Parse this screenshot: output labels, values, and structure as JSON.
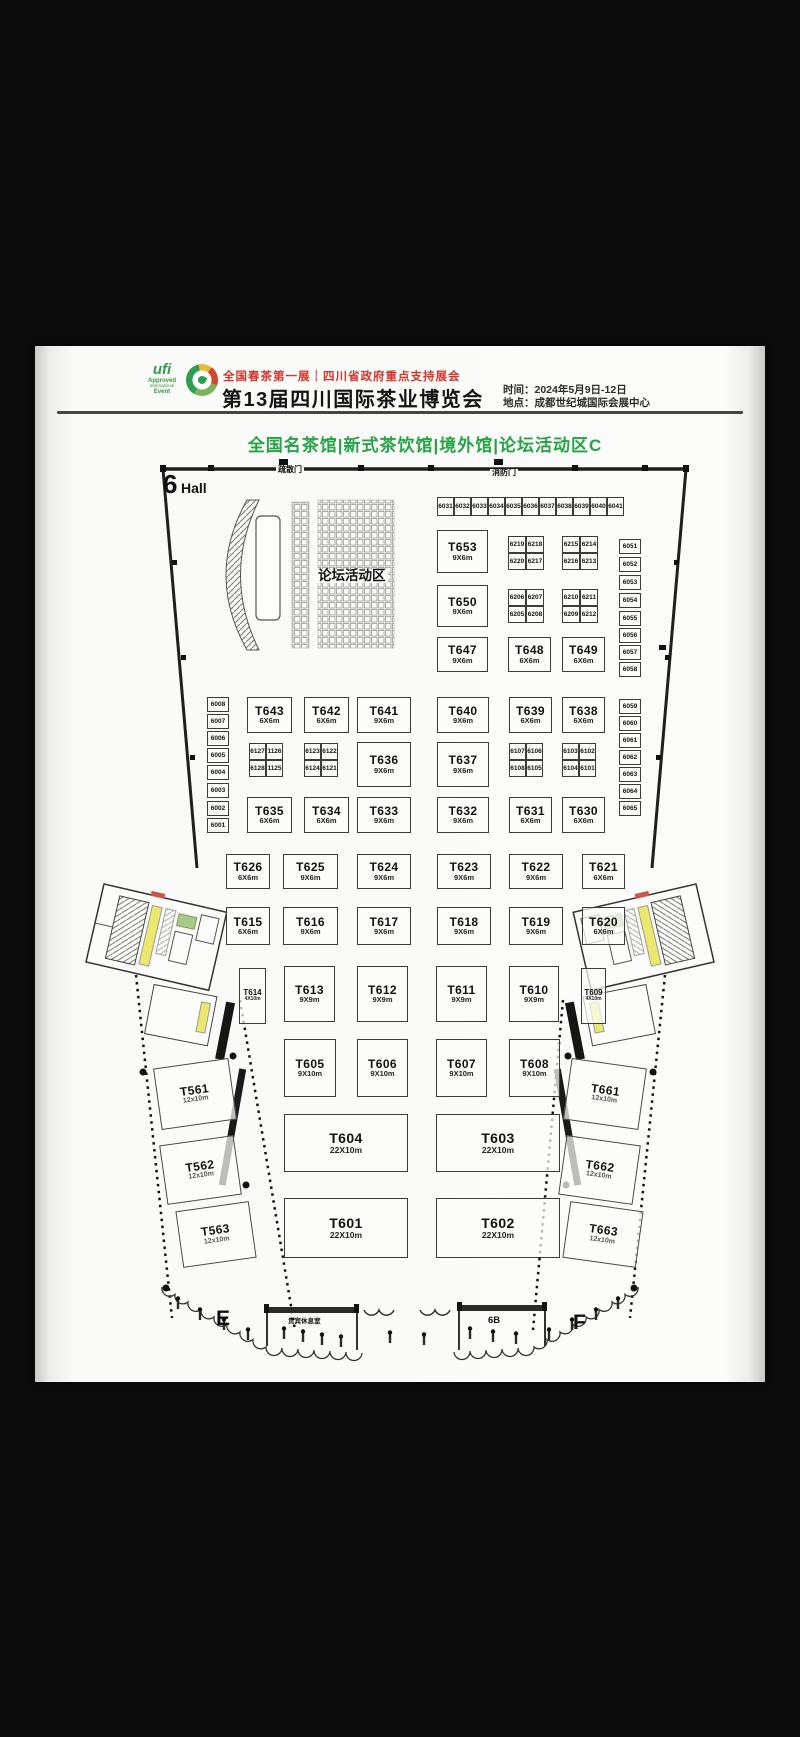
{
  "header": {
    "ufi_logo_lines": [
      "ufi",
      "Approved",
      "International",
      "Event"
    ],
    "expo_logo": "tea-expo-circle-logo",
    "tagline": "全国春茶第一展｜四川省政府重点支持展会",
    "title": "第13届四川国际茶业博览会",
    "time": "时间：2024年5月9日-12日",
    "venue": "地点：成都世纪城国际会展中心"
  },
  "subtitle": "全国名茶馆|新式茶饮馆|境外馆|论坛活动区C",
  "colors": {
    "accent_green": "#27a347",
    "accent_red": "#d6342b",
    "line": "#3b3b3b"
  },
  "floorplan": {
    "labels": [
      {
        "name": "hall-number",
        "text": "6",
        "x": 163,
        "y": 471,
        "fs": 26,
        "fw": 800
      },
      {
        "name": "hall-word",
        "text": "Hall",
        "x": 181,
        "y": 481,
        "fs": 14,
        "fw": 800
      },
      {
        "name": "door-evac-label",
        "text": "疏散门",
        "x": 276,
        "y": 466,
        "fs": 8,
        "fw": 700,
        "bg": 1
      },
      {
        "name": "door-fire-label",
        "text": "消防门",
        "x": 490,
        "y": 469,
        "fs": 8,
        "fw": 700,
        "bg": 1
      },
      {
        "name": "forum-area-label",
        "text": "论坛活动区",
        "x": 316,
        "y": 569,
        "fs": 13.5,
        "fw": 800,
        "bg": 1
      },
      {
        "name": "zone-e-label",
        "text": "E",
        "x": 216,
        "y": 1308,
        "fs": 21,
        "fw": 800
      },
      {
        "name": "zone-6b-label",
        "text": "6B",
        "x": 488,
        "y": 1316,
        "fs": 9.5,
        "fw": 800
      },
      {
        "name": "zone-f-label",
        "text": "F",
        "x": 573,
        "y": 1312,
        "fs": 21,
        "fw": 800
      },
      {
        "name": "vip-room-label",
        "text": "贵宾休息室",
        "x": 288,
        "y": 1319,
        "fs": 6.5,
        "fw": 600
      }
    ],
    "booths": [
      {
        "id": "T653",
        "size": "9X6m",
        "x": 437,
        "y": 530,
        "w": 51,
        "h": 43
      },
      {
        "id": "T650",
        "size": "9X6m",
        "x": 437,
        "y": 585,
        "w": 51,
        "h": 42
      },
      {
        "id": "T647",
        "size": "9X6m",
        "x": 437,
        "y": 637,
        "w": 51,
        "h": 35
      },
      {
        "id": "T648",
        "size": "6X6m",
        "x": 508,
        "y": 637,
        "w": 43,
        "h": 35
      },
      {
        "id": "T649",
        "size": "6X6m",
        "x": 562,
        "y": 637,
        "w": 43,
        "h": 35
      },
      {
        "id": "T643",
        "size": "6X6m",
        "x": 247,
        "y": 697,
        "w": 45,
        "h": 36
      },
      {
        "id": "T642",
        "size": "6X6m",
        "x": 304,
        "y": 697,
        "w": 45,
        "h": 36
      },
      {
        "id": "T641",
        "size": "9X6m",
        "x": 357,
        "y": 697,
        "w": 54,
        "h": 36
      },
      {
        "id": "T640",
        "size": "9X6m",
        "x": 437,
        "y": 697,
        "w": 52,
        "h": 36
      },
      {
        "id": "T639",
        "size": "6X6m",
        "x": 509,
        "y": 697,
        "w": 43,
        "h": 36
      },
      {
        "id": "T638",
        "size": "6X6m",
        "x": 562,
        "y": 697,
        "w": 43,
        "h": 36
      },
      {
        "id": "T636",
        "size": "9X6m",
        "x": 357,
        "y": 742,
        "w": 54,
        "h": 45
      },
      {
        "id": "T637",
        "size": "9X6m",
        "x": 437,
        "y": 742,
        "w": 52,
        "h": 45
      },
      {
        "id": "T635",
        "size": "6X6m",
        "x": 247,
        "y": 797,
        "w": 45,
        "h": 36
      },
      {
        "id": "T634",
        "size": "6X6m",
        "x": 304,
        "y": 797,
        "w": 45,
        "h": 36
      },
      {
        "id": "T633",
        "size": "9X6m",
        "x": 357,
        "y": 797,
        "w": 54,
        "h": 36
      },
      {
        "id": "T632",
        "size": "9X6m",
        "x": 437,
        "y": 797,
        "w": 52,
        "h": 36
      },
      {
        "id": "T631",
        "size": "6X6m",
        "x": 509,
        "y": 797,
        "w": 43,
        "h": 36
      },
      {
        "id": "T630",
        "size": "6X6m",
        "x": 562,
        "y": 797,
        "w": 43,
        "h": 36
      },
      {
        "id": "T626",
        "size": "6X6m",
        "x": 226,
        "y": 854,
        "w": 44,
        "h": 35
      },
      {
        "id": "T625",
        "size": "9X6m",
        "x": 283,
        "y": 854,
        "w": 55,
        "h": 35
      },
      {
        "id": "T624",
        "size": "9X6m",
        "x": 357,
        "y": 854,
        "w": 54,
        "h": 35
      },
      {
        "id": "T623",
        "size": "9X6m",
        "x": 437,
        "y": 854,
        "w": 54,
        "h": 35
      },
      {
        "id": "T622",
        "size": "9X6m",
        "x": 509,
        "y": 854,
        "w": 54,
        "h": 35
      },
      {
        "id": "T621",
        "size": "6X6m",
        "x": 582,
        "y": 854,
        "w": 43,
        "h": 35
      },
      {
        "id": "T615",
        "size": "6X6m",
        "x": 226,
        "y": 907,
        "w": 44,
        "h": 38
      },
      {
        "id": "T616",
        "size": "9X6m",
        "x": 283,
        "y": 907,
        "w": 55,
        "h": 38
      },
      {
        "id": "T617",
        "size": "9X6m",
        "x": 357,
        "y": 907,
        "w": 54,
        "h": 38
      },
      {
        "id": "T618",
        "size": "9X6m",
        "x": 437,
        "y": 907,
        "w": 54,
        "h": 38
      },
      {
        "id": "T619",
        "size": "9X6m",
        "x": 509,
        "y": 907,
        "w": 54,
        "h": 38
      },
      {
        "id": "T620",
        "size": "6X6m",
        "x": 582,
        "y": 907,
        "w": 43,
        "h": 38
      },
      {
        "id": "T614",
        "size": "4X10m",
        "x": 239,
        "y": 968,
        "w": 27,
        "h": 56,
        "kind": "narrow"
      },
      {
        "id": "T613",
        "size": "9X9m",
        "x": 284,
        "y": 966,
        "w": 51,
        "h": 56
      },
      {
        "id": "T612",
        "size": "9X9m",
        "x": 357,
        "y": 966,
        "w": 51,
        "h": 56
      },
      {
        "id": "T611",
        "size": "9X9m",
        "x": 436,
        "y": 966,
        "w": 51,
        "h": 56
      },
      {
        "id": "T610",
        "size": "9X9m",
        "x": 509,
        "y": 966,
        "w": 50,
        "h": 56
      },
      {
        "id": "T609",
        "size": "4X10m",
        "x": 581,
        "y": 968,
        "w": 25,
        "h": 56,
        "kind": "narrow"
      },
      {
        "id": "T605",
        "size": "9X10m",
        "x": 284,
        "y": 1039,
        "w": 52,
        "h": 58
      },
      {
        "id": "T606",
        "size": "9X10m",
        "x": 357,
        "y": 1039,
        "w": 51,
        "h": 58
      },
      {
        "id": "T607",
        "size": "9X10m",
        "x": 436,
        "y": 1039,
        "w": 51,
        "h": 58
      },
      {
        "id": "T608",
        "size": "9X10m",
        "x": 509,
        "y": 1039,
        "w": 51,
        "h": 58
      },
      {
        "id": "T604",
        "size": "22X10m",
        "x": 284,
        "y": 1114,
        "w": 124,
        "h": 58,
        "kind": "wide"
      },
      {
        "id": "T603",
        "size": "22X10m",
        "x": 436,
        "y": 1114,
        "w": 124,
        "h": 58,
        "kind": "wide"
      },
      {
        "id": "T601",
        "size": "22X10m",
        "x": 284,
        "y": 1198,
        "w": 124,
        "h": 60,
        "kind": "wide"
      },
      {
        "id": "T602",
        "size": "22X10m",
        "x": 436,
        "y": 1198,
        "w": 124,
        "h": 60,
        "kind": "wide"
      },
      {
        "id": "T561",
        "size": "12x10m",
        "x": 157,
        "y": 1063,
        "w": 76,
        "h": 62,
        "kind": "wing",
        "rot": -8
      },
      {
        "id": "T562",
        "size": "12x10m",
        "x": 163,
        "y": 1140,
        "w": 75,
        "h": 60,
        "kind": "wing",
        "rot": -8
      },
      {
        "id": "T563",
        "size": "12x10m",
        "x": 179,
        "y": 1206,
        "w": 74,
        "h": 57,
        "kind": "wing",
        "rot": -8
      },
      {
        "id": "T661",
        "size": "12x10m",
        "x": 567,
        "y": 1063,
        "w": 76,
        "h": 62,
        "kind": "wing",
        "rot": 8
      },
      {
        "id": "T662",
        "size": "12x10m",
        "x": 562,
        "y": 1140,
        "w": 75,
        "h": 60,
        "kind": "wing",
        "rot": 8
      },
      {
        "id": "T663",
        "size": "12x10m",
        "x": 566,
        "y": 1206,
        "w": 74,
        "h": 57,
        "kind": "wing",
        "rot": 8
      }
    ],
    "small_booths": [
      {
        "id": "6031",
        "x": 437,
        "y": 497,
        "w": 17,
        "h": 19
      },
      {
        "id": "6032",
        "x": 454,
        "y": 497,
        "w": 17,
        "h": 19
      },
      {
        "id": "6033",
        "x": 471,
        "y": 497,
        "w": 17,
        "h": 19
      },
      {
        "id": "6034",
        "x": 488,
        "y": 497,
        "w": 17,
        "h": 19
      },
      {
        "id": "6035",
        "x": 505,
        "y": 497,
        "w": 17,
        "h": 19
      },
      {
        "id": "6036",
        "x": 522,
        "y": 497,
        "w": 17,
        "h": 19
      },
      {
        "id": "6037",
        "x": 539,
        "y": 497,
        "w": 17,
        "h": 19
      },
      {
        "id": "6038",
        "x": 556,
        "y": 497,
        "w": 17,
        "h": 19
      },
      {
        "id": "6039",
        "x": 573,
        "y": 497,
        "w": 17,
        "h": 19
      },
      {
        "id": "6040",
        "x": 590,
        "y": 497,
        "w": 17,
        "h": 19
      },
      {
        "id": "6041",
        "x": 607,
        "y": 497,
        "w": 17,
        "h": 19
      },
      {
        "id": "6219",
        "x": 508,
        "y": 536,
        "w": 18,
        "h": 17
      },
      {
        "id": "6218",
        "x": 526,
        "y": 536,
        "w": 18,
        "h": 17
      },
      {
        "id": "6220",
        "x": 508,
        "y": 553,
        "w": 18,
        "h": 17
      },
      {
        "id": "6217",
        "x": 526,
        "y": 553,
        "w": 18,
        "h": 17
      },
      {
        "id": "6215",
        "x": 562,
        "y": 536,
        "w": 18,
        "h": 17
      },
      {
        "id": "6214",
        "x": 580,
        "y": 536,
        "w": 18,
        "h": 17
      },
      {
        "id": "6216",
        "x": 562,
        "y": 553,
        "w": 18,
        "h": 17
      },
      {
        "id": "6213",
        "x": 580,
        "y": 553,
        "w": 18,
        "h": 17
      },
      {
        "id": "6206",
        "x": 508,
        "y": 589,
        "w": 18,
        "h": 17
      },
      {
        "id": "6207",
        "x": 526,
        "y": 589,
        "w": 18,
        "h": 17
      },
      {
        "id": "6205",
        "x": 508,
        "y": 606,
        "w": 18,
        "h": 17
      },
      {
        "id": "6208",
        "x": 526,
        "y": 606,
        "w": 18,
        "h": 17
      },
      {
        "id": "6210",
        "x": 562,
        "y": 589,
        "w": 18,
        "h": 17
      },
      {
        "id": "6211",
        "x": 580,
        "y": 589,
        "w": 18,
        "h": 17
      },
      {
        "id": "6209",
        "x": 562,
        "y": 606,
        "w": 18,
        "h": 17
      },
      {
        "id": "6212",
        "x": 580,
        "y": 606,
        "w": 18,
        "h": 17
      },
      {
        "id": "6127",
        "x": 249,
        "y": 743,
        "w": 17,
        "h": 17
      },
      {
        "id": "1126",
        "x": 266,
        "y": 743,
        "w": 17,
        "h": 17
      },
      {
        "id": "6128",
        "x": 249,
        "y": 760,
        "w": 17,
        "h": 17
      },
      {
        "id": "1125",
        "x": 266,
        "y": 760,
        "w": 17,
        "h": 17
      },
      {
        "id": "6123",
        "x": 304,
        "y": 743,
        "w": 17,
        "h": 17
      },
      {
        "id": "6122",
        "x": 321,
        "y": 743,
        "w": 17,
        "h": 17
      },
      {
        "id": "6124",
        "x": 304,
        "y": 760,
        "w": 17,
        "h": 17
      },
      {
        "id": "6121",
        "x": 321,
        "y": 760,
        "w": 17,
        "h": 17
      },
      {
        "id": "6107",
        "x": 509,
        "y": 743,
        "w": 17,
        "h": 17
      },
      {
        "id": "6106",
        "x": 526,
        "y": 743,
        "w": 17,
        "h": 17
      },
      {
        "id": "6108",
        "x": 509,
        "y": 760,
        "w": 17,
        "h": 17
      },
      {
        "id": "6105",
        "x": 526,
        "y": 760,
        "w": 17,
        "h": 17
      },
      {
        "id": "6103",
        "x": 562,
        "y": 743,
        "w": 17,
        "h": 17
      },
      {
        "id": "6102",
        "x": 579,
        "y": 743,
        "w": 17,
        "h": 17
      },
      {
        "id": "6104",
        "x": 562,
        "y": 760,
        "w": 17,
        "h": 17
      },
      {
        "id": "6101",
        "x": 579,
        "y": 760,
        "w": 17,
        "h": 17
      },
      {
        "id": "6051",
        "x": 619,
        "y": 539,
        "w": 22,
        "h": 15
      },
      {
        "id": "6052",
        "x": 619,
        "y": 557,
        "w": 22,
        "h": 15
      },
      {
        "id": "6053",
        "x": 619,
        "y": 575,
        "w": 22,
        "h": 15
      },
      {
        "id": "6054",
        "x": 619,
        "y": 593,
        "w": 22,
        "h": 15
      },
      {
        "id": "6055",
        "x": 619,
        "y": 611,
        "w": 22,
        "h": 15
      },
      {
        "id": "6056",
        "x": 619,
        "y": 628,
        "w": 22,
        "h": 15
      },
      {
        "id": "6057",
        "x": 619,
        "y": 645,
        "w": 22,
        "h": 15
      },
      {
        "id": "6058",
        "x": 619,
        "y": 662,
        "w": 22,
        "h": 15
      },
      {
        "id": "6059",
        "x": 619,
        "y": 699,
        "w": 22,
        "h": 15
      },
      {
        "id": "6060",
        "x": 619,
        "y": 716,
        "w": 22,
        "h": 15
      },
      {
        "id": "6061",
        "x": 619,
        "y": 733,
        "w": 22,
        "h": 15
      },
      {
        "id": "6062",
        "x": 619,
        "y": 750,
        "w": 22,
        "h": 15
      },
      {
        "id": "6063",
        "x": 619,
        "y": 767,
        "w": 22,
        "h": 15
      },
      {
        "id": "6064",
        "x": 619,
        "y": 784,
        "w": 22,
        "h": 15
      },
      {
        "id": "6065",
        "x": 619,
        "y": 801,
        "w": 22,
        "h": 15
      },
      {
        "id": "6008",
        "x": 207,
        "y": 697,
        "w": 22,
        "h": 15
      },
      {
        "id": "6007",
        "x": 207,
        "y": 714,
        "w": 22,
        "h": 15
      },
      {
        "id": "6006",
        "x": 207,
        "y": 731,
        "w": 22,
        "h": 15
      },
      {
        "id": "6005",
        "x": 207,
        "y": 748,
        "w": 22,
        "h": 15
      },
      {
        "id": "6004",
        "x": 207,
        "y": 765,
        "w": 22,
        "h": 15
      },
      {
        "id": "6003",
        "x": 207,
        "y": 783,
        "w": 22,
        "h": 15
      },
      {
        "id": "6002",
        "x": 207,
        "y": 801,
        "w": 22,
        "h": 15
      },
      {
        "id": "6001",
        "x": 207,
        "y": 818,
        "w": 22,
        "h": 15
      }
    ]
  }
}
